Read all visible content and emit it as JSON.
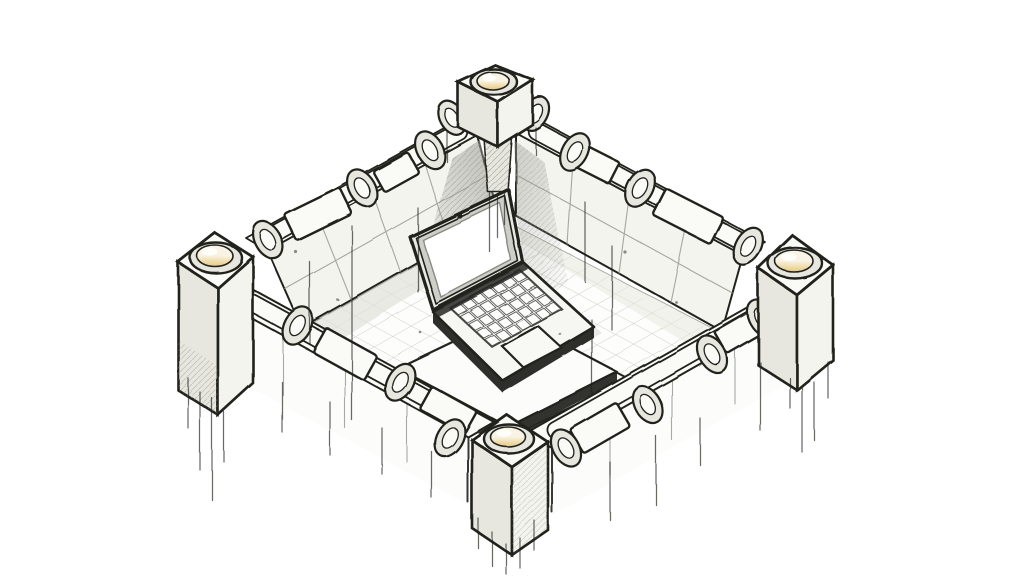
{
  "canvas": {
    "width": 1024,
    "height": 576
  },
  "illustration": {
    "type": "hand-drawn isometric ink sketch",
    "subject": "Open laptop with a blank white screen sitting on stacked stone slabs inside a square fortified wall enclosure; four corner towers topped with glowing dome lights, walls topped with pipe segments and collar rings, ink drip lines below the walls",
    "elements": {
      "towers": {
        "count": 4,
        "feature": "cube pedestal with recessed glowing dome light"
      },
      "walls": {
        "count": 4,
        "feature": "stone block walls topped with pipes and collar rings"
      },
      "laptop": {
        "screen": "blank white",
        "parts": [
          "webcam",
          "keyboard",
          "trackpad"
        ]
      },
      "platform": "two stacked stone slabs",
      "floor": "tiled square courtyard",
      "accents": [
        "ink drip lines",
        "hatched corner shadows"
      ]
    }
  },
  "colors": {
    "paper": "#ffffff",
    "ink": "#22221f",
    "wall_top": "#fafaf7",
    "wall_light": "#f4f4ef",
    "wall_shade": "#e7e7e0",
    "seam": "#8d8d86",
    "grid": "#cbcbc3",
    "corner_shadow": "#9a9a93",
    "dome_cream": "#f8f3e4",
    "dome_glow": "#e8c87c",
    "screen": "#ffffff",
    "deck_edge": "#2e2e2b"
  }
}
